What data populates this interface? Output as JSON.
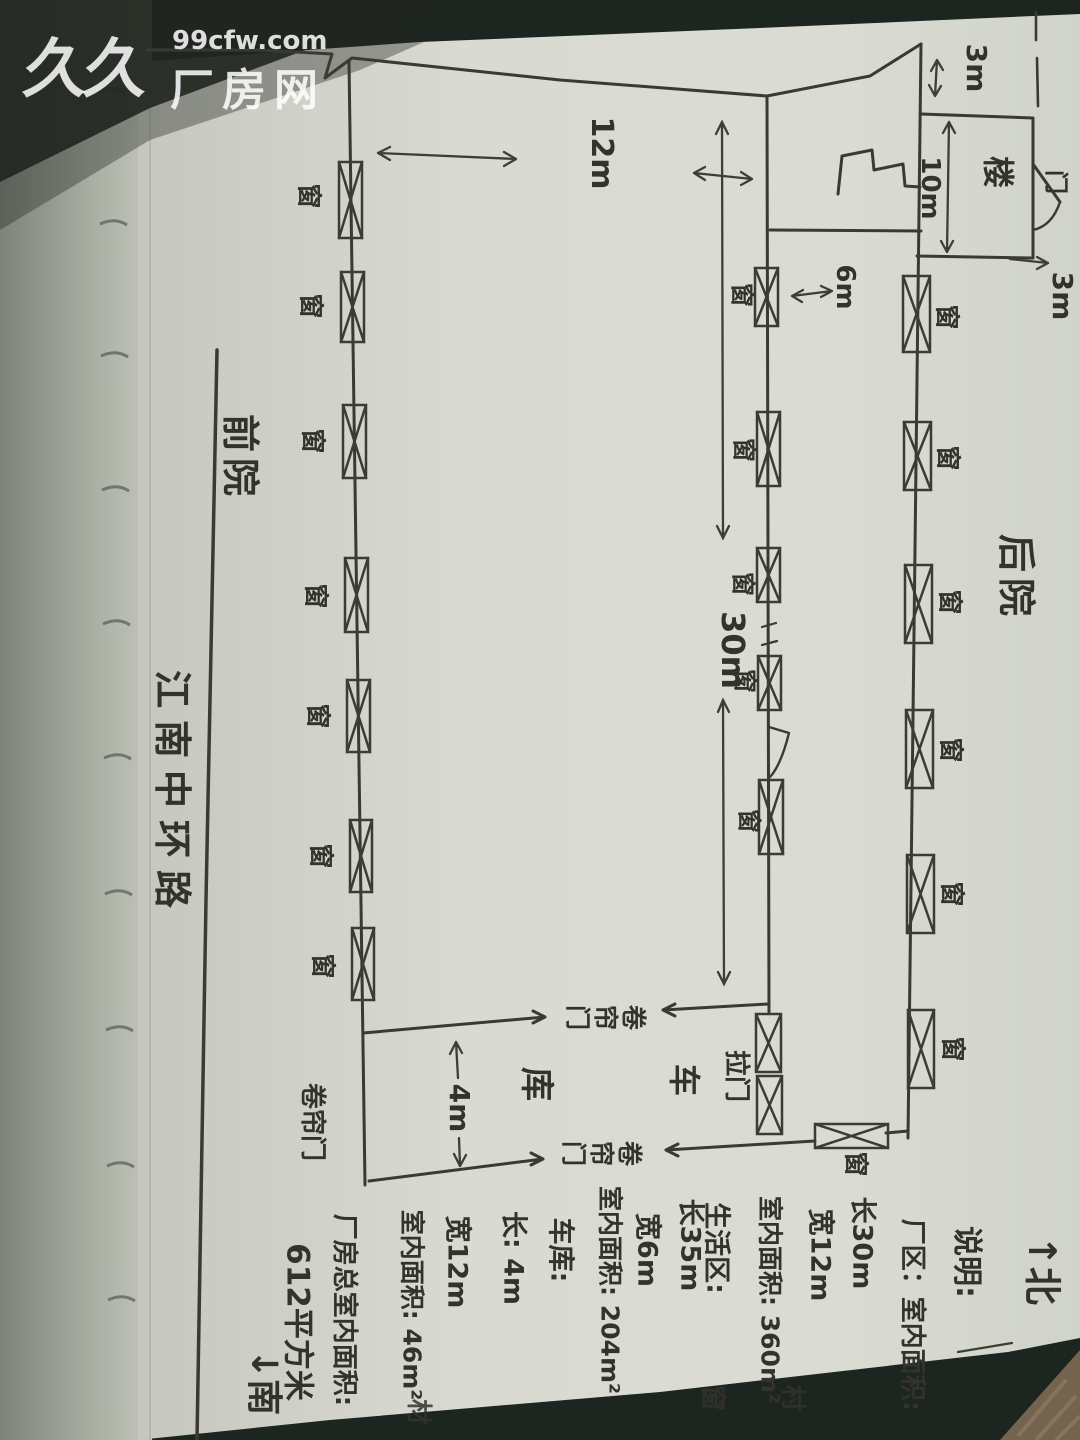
{
  "watermark": {
    "logo": "久久",
    "site_url": "99cfw.com",
    "site_name": "厂房网"
  },
  "labels": {
    "window": "窗",
    "door": "门",
    "roller_door": "卷帘门",
    "sliding_door": "拉门",
    "stairs": "楼",
    "garage_room": "库",
    "vehicle": "车",
    "front_yard": "前院",
    "back_yard": "后院",
    "road": "江南中环路",
    "north": "↑北",
    "south": "↓南"
  },
  "dimensions": {
    "top_3m": "3m",
    "stair_10m": "10m",
    "stair_3m": "3m",
    "width_12m": "12m",
    "living_6m": "6m",
    "length_30m": "30m",
    "garage_4m": "4m"
  },
  "notes": {
    "title": "说明:",
    "lines": [
      "厂区：室内面积:",
      "长30m",
      "宽12m",
      "室内面积: 360m²",
      "生活区:",
      "长35m",
      "宽6m",
      "室内面积: 204m²",
      "车库:",
      "长: 4m",
      "宽12m",
      "室内面积: 46m²",
      "厂房总室内面积:",
      "612平方米"
    ]
  },
  "edge_chars": [
    "材",
    "窗",
    "村"
  ]
}
